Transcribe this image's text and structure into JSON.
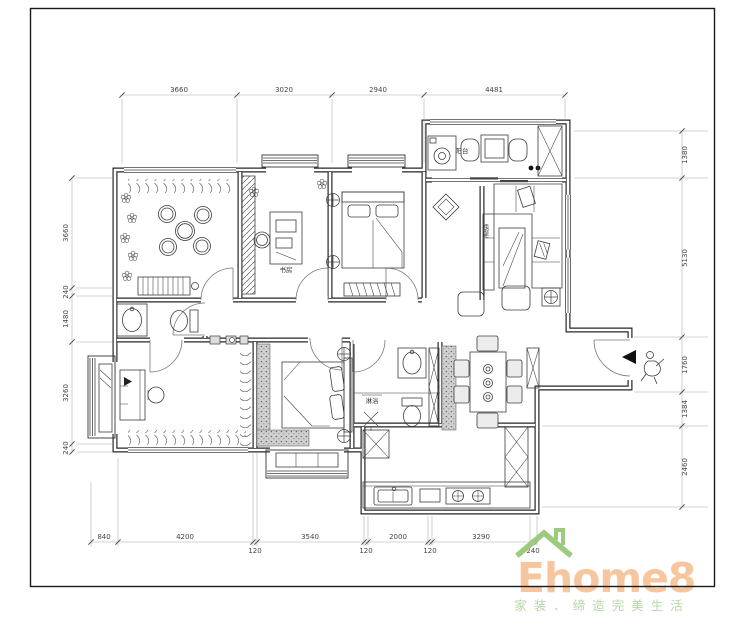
{
  "plan": {
    "rooms": {
      "study": "书房",
      "balcony": "阳台",
      "shower": "淋浴",
      "tv_cabinet": "电视柜"
    },
    "dims": {
      "top": [
        "3660",
        "3020",
        "2940",
        "4481"
      ],
      "bottom": [
        "840",
        "4200",
        "120",
        "3540",
        "120",
        "2000",
        "120",
        "3290",
        "240"
      ],
      "left": [
        "3660",
        "240",
        "1480",
        "3260",
        "240"
      ],
      "right": [
        "1380",
        "5130",
        "1760",
        "1384",
        "2460"
      ]
    }
  },
  "logo": {
    "brand": "Ehome8",
    "tagline": "家装．缔造完美生活",
    "brand_color": "#f6c79e",
    "tagline_color": "#b7d8a6",
    "roof_color": "#9bcb7b"
  }
}
